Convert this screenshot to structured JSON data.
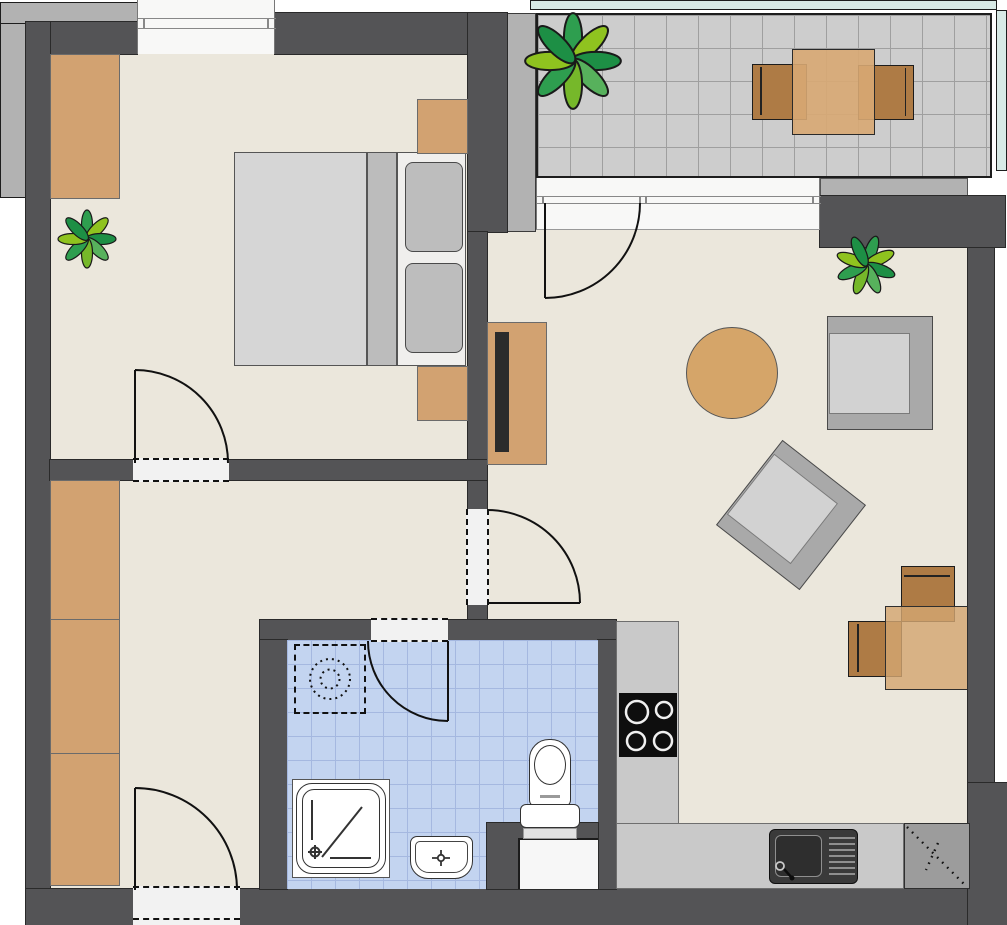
{
  "document": {
    "kind": "apartment-floor-plan",
    "style": "2d-top-down",
    "visible_text": "none"
  },
  "colors": {
    "wall": "#545456",
    "wall_outline": "#1F1F1F",
    "floor": "#EBE7DC",
    "wood_light": "#D2A271",
    "wood_dark": "#AE7B45",
    "desk_overlay": "rgba(211,166,113,0.82)",
    "furniture_gray": "#A9A9A9",
    "cushion_gray": "#D2D2D2",
    "bed_mattress": "#D6D6D6",
    "bed_pillow_zone": "#F0EFED",
    "balcony_tile": "#CDCDCD",
    "bath_tile": "#C3D4F0",
    "railing": "#D8EAE6",
    "counter": "#C9C9C9",
    "corner_cabinet": "#9C9C9C",
    "stove": "#0E0E0E",
    "sink_metal": "#3A3A3A",
    "plant_greens": [
      "#2E9E4F",
      "#8FC31F",
      "#1D8F45",
      "#57B15C"
    ],
    "outer_structure_gray": "#B2B2B2",
    "window_glass": "#F8F8F7",
    "tv": "#2B2B2B"
  },
  "rooms": [
    {
      "id": "bedroom",
      "label": "Bedroom",
      "furniture": [
        "wardrobe",
        "double-bed",
        "pillow x2",
        "nightstand x2",
        "plant"
      ]
    },
    {
      "id": "hallway",
      "label": "Hallway",
      "furniture": [
        "wardrobe-section x3"
      ],
      "doors": [
        "entry-door",
        "bedroom-door",
        "living-room-door",
        "bathroom-door"
      ]
    },
    {
      "id": "bathroom",
      "label": "Bathroom",
      "furniture": [
        "washing-machine-placeholder (dashed)",
        "shower",
        "washbasin",
        "toilet",
        "toilet-niche"
      ]
    },
    {
      "id": "living-kitchen",
      "label": "Living room with open kitchen",
      "furniture": [
        "sideboard-with-tv",
        "round-coffee-table",
        "armchair",
        "armchair-rotated",
        "plant",
        "desk",
        "desk-chair x2",
        "kitchen-counter-L",
        "cooktop-4-burners",
        "kitchen-sink-with-drainer",
        "corner-cabinet-dotted"
      ]
    },
    {
      "id": "balcony",
      "label": "Balcony",
      "furniture": [
        "plant-large",
        "dining-table",
        "balcony-chair x2"
      ],
      "features": [
        "tiled-floor",
        "railing-teal"
      ]
    }
  ],
  "doors": [
    {
      "id": "balcony-door",
      "between": [
        "balcony",
        "living-kitchen"
      ],
      "swing": "into-living-room"
    },
    {
      "id": "bedroom-door",
      "between": [
        "hallway",
        "bedroom"
      ],
      "swing": "into-bedroom"
    },
    {
      "id": "living-room-door",
      "between": [
        "hallway",
        "living-kitchen"
      ],
      "swing": "into-living-room"
    },
    {
      "id": "bathroom-door",
      "between": [
        "hallway",
        "bathroom"
      ],
      "swing": "into-bathroom"
    },
    {
      "id": "entry-door",
      "between": [
        "outside",
        "hallway"
      ],
      "swing": "into-hallway"
    }
  ],
  "windows": [
    {
      "id": "bedroom-window",
      "wall": "top"
    },
    {
      "id": "living-room-window-front",
      "wall": "top",
      "note": "wide glazing next to balcony door"
    }
  ],
  "appliances": {
    "cooktop_burners": 4,
    "sink_drainer_grooves": 8,
    "washing_machine": "dashed outline with dotted drum circles"
  }
}
